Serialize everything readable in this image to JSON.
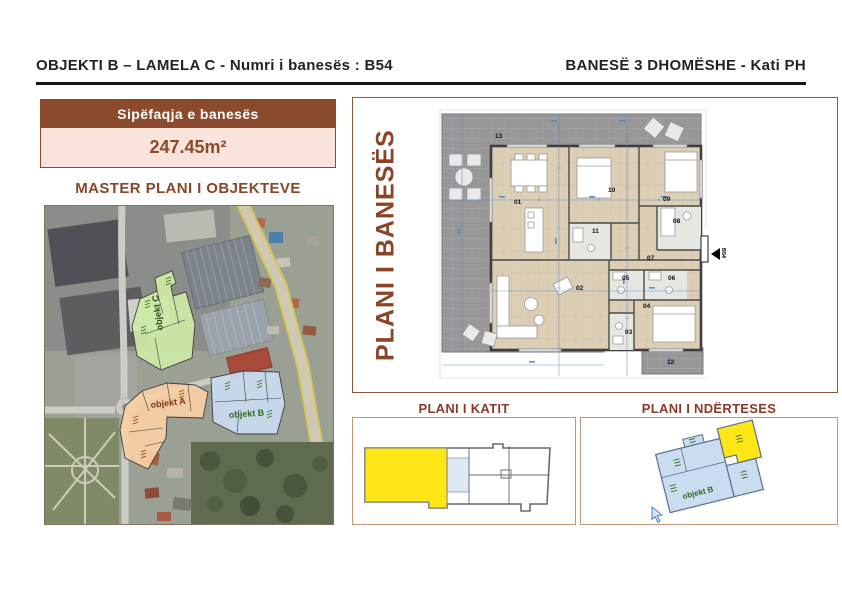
{
  "header": {
    "left_title": "OBJEKTI B – LAMELA C - Numri i banesës : B54",
    "right_title": "BANESË 3 DHOMËSHE - Kati PH"
  },
  "area_box": {
    "label": "Sipëfaqja e banesës",
    "value": "247.45m²"
  },
  "master_plan": {
    "title": "MASTER PLANI I OBJEKTEVE",
    "buildings": [
      {
        "label": "objekt C",
        "color": "#cdeaa6"
      },
      {
        "label": "objekt A",
        "color": "#f8cfa4"
      },
      {
        "label": "objekt B",
        "color": "#c9dcf0"
      }
    ]
  },
  "apartment_plan": {
    "title": "PLANI I BANESËS",
    "entrance_label": "B54",
    "rooms": [
      "01",
      "02",
      "03",
      "04",
      "05",
      "06",
      "07",
      "08",
      "09",
      "10",
      "11",
      "12",
      "13"
    ]
  },
  "floor_plan": {
    "title": "PLANI I KATIT",
    "highlight_color": "#ffe617"
  },
  "building_plan": {
    "title": "PLANI I NDËRTESES",
    "building_label": "objekt B",
    "highlight_color": "#ffe617"
  },
  "colors": {
    "accent_brown": "#8a4a2b",
    "value_bg": "#f9e3da",
    "dimension_blue": "#4a86c8",
    "terrace_gray": "#979797",
    "wood": "#dccfb6"
  }
}
